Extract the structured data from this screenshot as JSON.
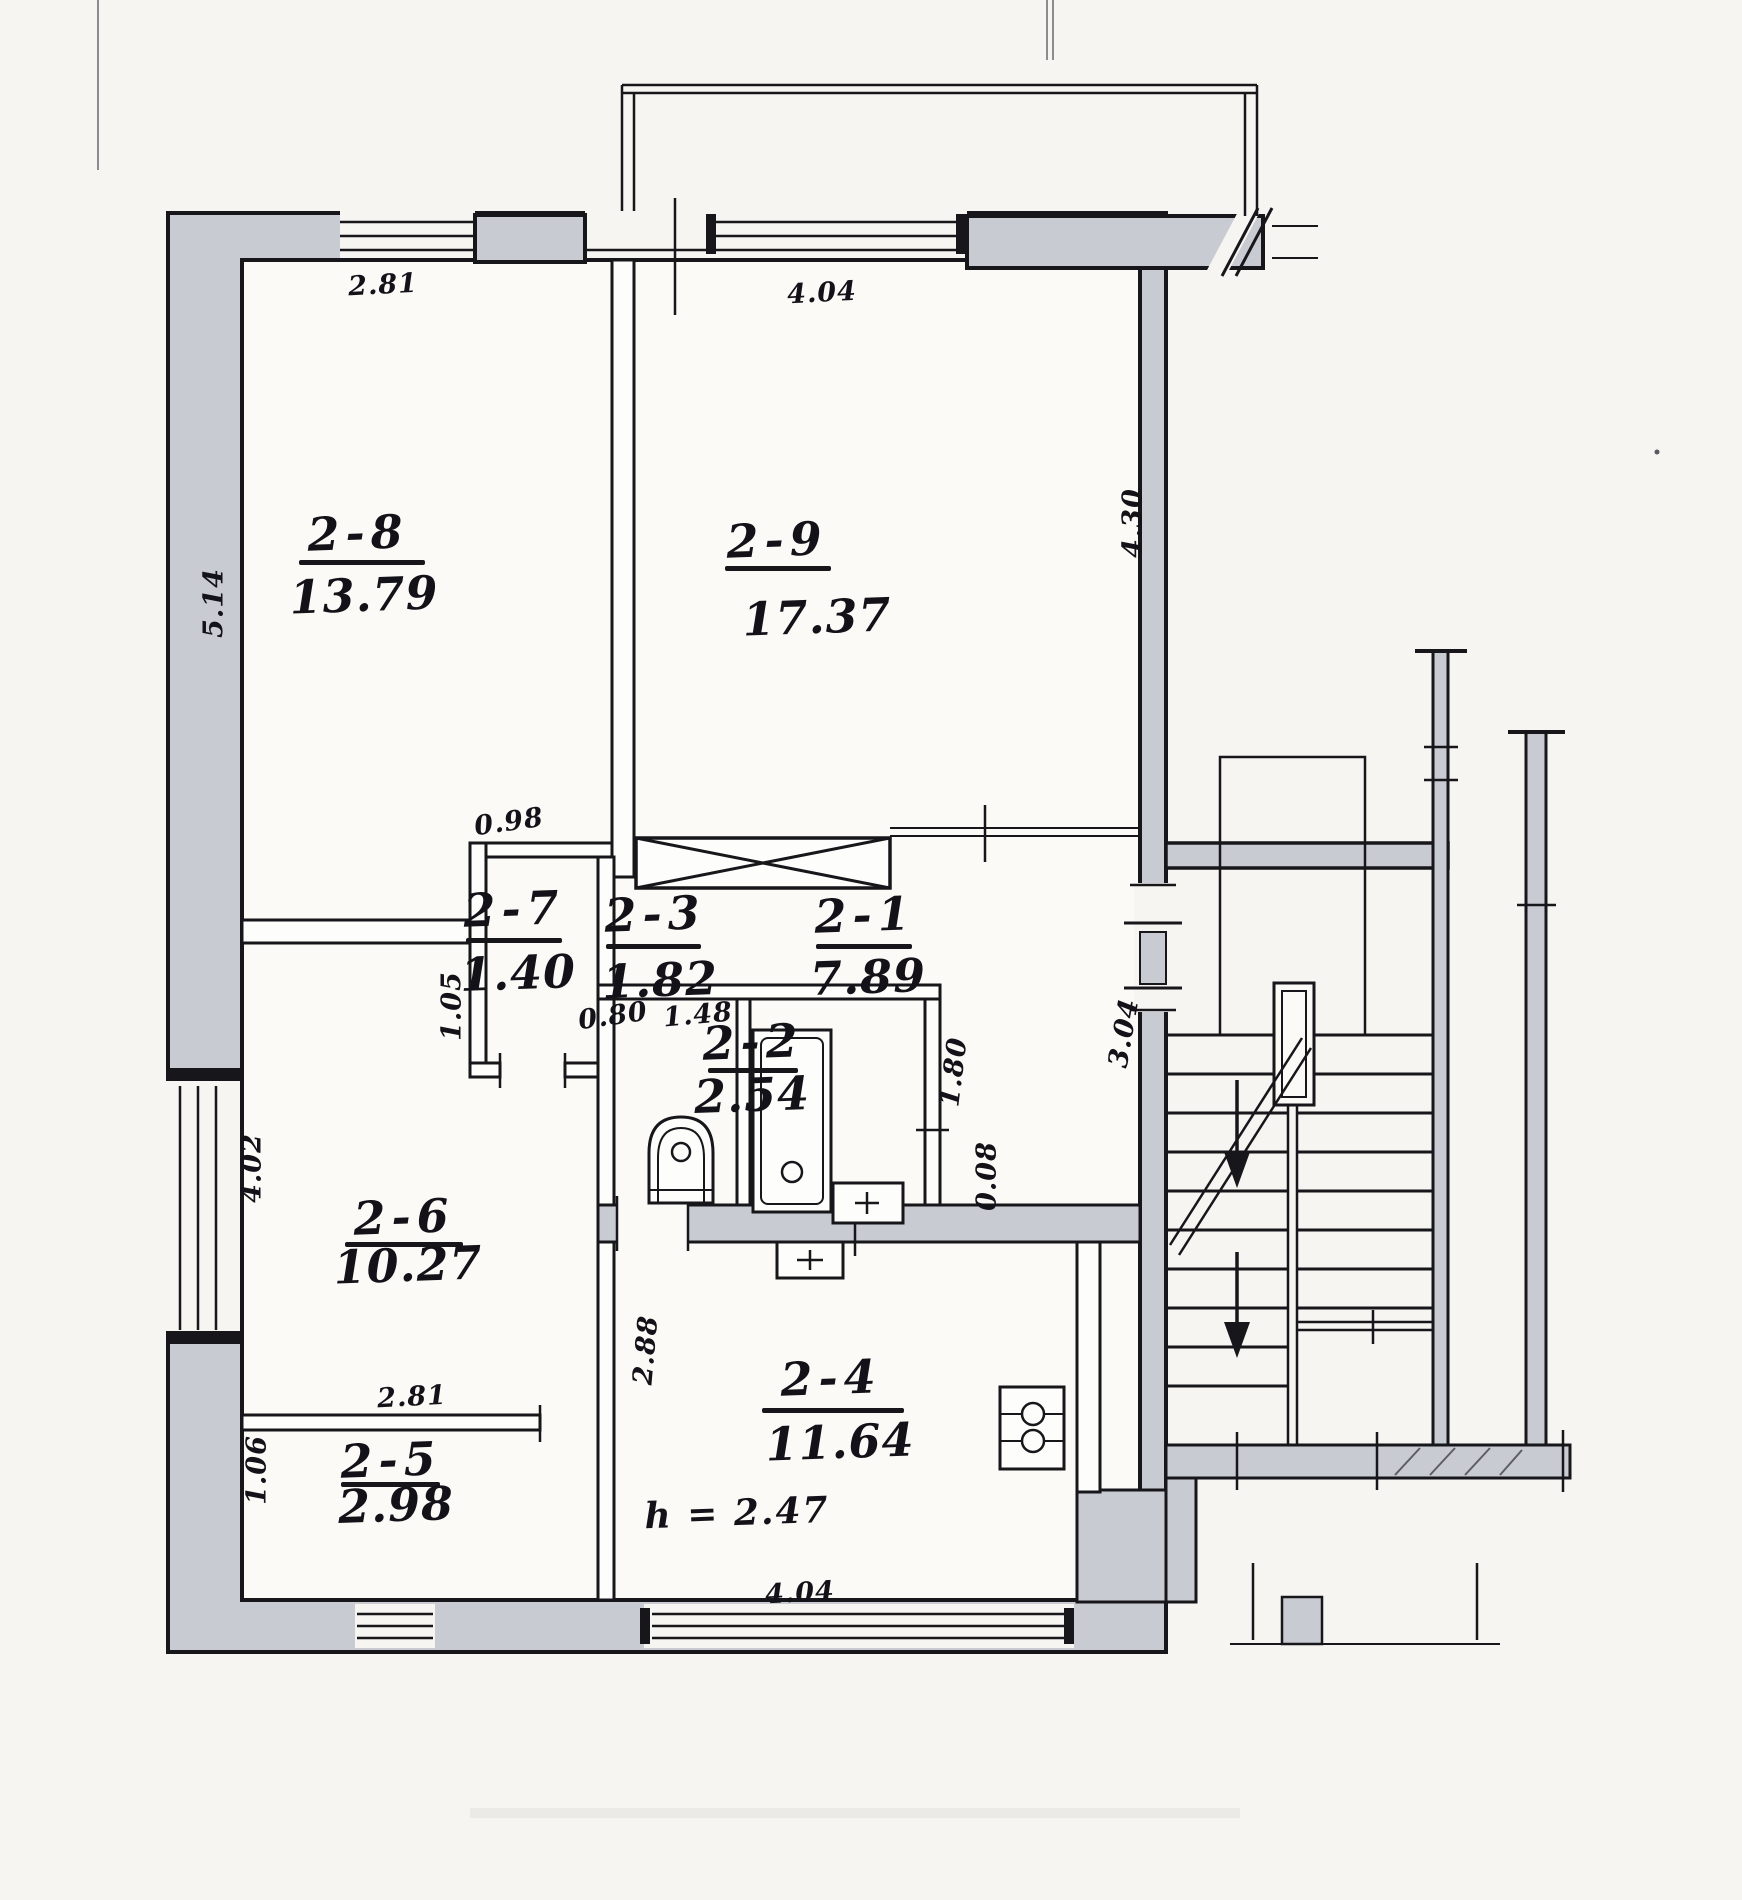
{
  "document": {
    "type": "scanned apartment floor plan",
    "description": "BTI technical floor plan of apartment unit 2 with staircase block",
    "height_note": "h = 2.47"
  },
  "colors": {
    "paper": "#f6f5f1",
    "ink": "#17161b",
    "wall_fill": "#c9cbd3"
  },
  "plan": {
    "rooms": [
      {
        "number": "2-8",
        "area": "13.79",
        "nx": 358,
        "ny": 533,
        "ax": 364,
        "ay": 595,
        "bx": 299,
        "by": 560,
        "bw": 126
      },
      {
        "number": "2-9",
        "area": "17.37",
        "nx": 777,
        "ny": 540,
        "ax": 817,
        "ay": 617,
        "bx": 725,
        "by": 566,
        "bw": 106
      },
      {
        "number": "2-7",
        "area": "1.40",
        "nx": 514,
        "ny": 909,
        "ax": 518,
        "ay": 973,
        "bx": 466,
        "by": 938,
        "bw": 96
      },
      {
        "number": "2-3",
        "area": "1.82",
        "nx": 655,
        "ny": 914,
        "ax": 660,
        "ay": 980,
        "bx": 606,
        "by": 944,
        "bw": 95
      },
      {
        "number": "2-1",
        "area": "7.89",
        "nx": 865,
        "ny": 915,
        "ax": 868,
        "ay": 977,
        "bx": 816,
        "by": 944,
        "bw": 96
      },
      {
        "number": "2-2",
        "area": "2.54",
        "nx": 753,
        "ny": 1042,
        "ax": 752,
        "ay": 1095,
        "bx": 708,
        "by": 1068,
        "bw": 90
      },
      {
        "number": "2-6",
        "area": "10.27",
        "nx": 404,
        "ny": 1217,
        "ax": 408,
        "ay": 1265,
        "bx": 345,
        "by": 1242,
        "bw": 118
      },
      {
        "number": "2-5",
        "area": "2.98",
        "nx": 391,
        "ny": 1460,
        "ax": 396,
        "ay": 1505,
        "bx": 341,
        "by": 1482,
        "bw": 99
      },
      {
        "number": "2-4",
        "area": "11.64",
        "nx": 831,
        "ny": 1378,
        "ax": 840,
        "ay": 1442,
        "bx": 762,
        "by": 1408,
        "bw": 142
      }
    ],
    "dimensions": [
      {
        "text": "2.81",
        "x": 383,
        "y": 285,
        "rot": -3
      },
      {
        "text": "4.04",
        "x": 822,
        "y": 293,
        "rot": -3
      },
      {
        "text": "5.14",
        "x": 214,
        "y": 603,
        "rot": -90
      },
      {
        "text": "4.30",
        "x": 1133,
        "y": 523,
        "rot": -90
      },
      {
        "text": "0.98",
        "x": 509,
        "y": 822,
        "rot": -8
      },
      {
        "text": "1.05",
        "x": 452,
        "y": 1006,
        "rot": -90
      },
      {
        "text": "0.80",
        "x": 613,
        "y": 1016,
        "rot": -8
      },
      {
        "text": "1.48",
        "x": 698,
        "y": 1015,
        "rot": -5
      },
      {
        "text": "1.80",
        "x": 954,
        "y": 1072,
        "rot": -83
      },
      {
        "text": "0.08",
        "x": 987,
        "y": 1176,
        "rot": -90
      },
      {
        "text": "3.04",
        "x": 1124,
        "y": 1033,
        "rot": -80
      },
      {
        "text": "2.88",
        "x": 646,
        "y": 1350,
        "rot": -85
      },
      {
        "text": "4.02",
        "x": 252,
        "y": 1168,
        "rot": -90
      },
      {
        "text": "2.81",
        "x": 412,
        "y": 1397,
        "rot": -3
      },
      {
        "text": "1.06",
        "x": 257,
        "y": 1470,
        "rot": -90
      },
      {
        "text": "4.04",
        "x": 800,
        "y": 1593,
        "rot": -3
      }
    ],
    "notes": [
      {
        "text": "h = 2.47",
        "x": 737,
        "y": 1513,
        "rot": -2
      }
    ]
  }
}
